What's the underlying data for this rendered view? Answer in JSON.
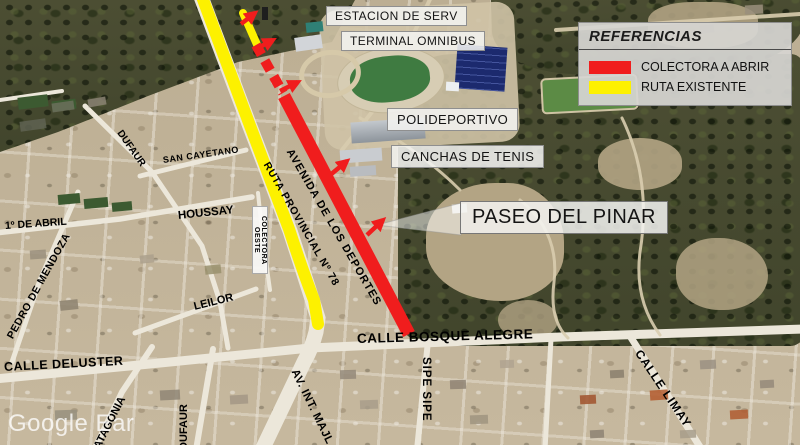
{
  "map": {
    "attribution": "Google Ear",
    "legend": {
      "title": "REFERENCIAS",
      "items": [
        {
          "id": "colectora",
          "label": "COLECTORA A ABRIR",
          "color": "#f01d1d"
        },
        {
          "id": "existente",
          "label": "RUTA EXISTENTE",
          "color": "#fdf100"
        }
      ]
    },
    "callouts": {
      "estacion": "ESTACION DE SERV",
      "terminal": "TERMINAL OMNIBUS",
      "polideportivo": "POLIDEPORTIVO",
      "canchas": "CANCHAS DE TENIS",
      "paseo": "PASEO DEL PINAR"
    },
    "streets": {
      "avenida_deportes": "AVENIDA DE LOS DEPORTES",
      "ruta_provincial": "RUTA PROVINCIAL Nº 78",
      "colectora_oeste": "COLECTORA OESTE",
      "dufaur_norte": "DUFAUR",
      "san_cayetano": "SAN CAYETANO",
      "houssay": "HOUSSAY",
      "primero_de_abril": "1º DE ABRIL",
      "pedro_de_mendoza": "PEDRO DE MENDOZA",
      "leilor": "LEILOR",
      "calle_deluster": "CALLE DELUSTER",
      "patagonia": "PATAGONIA",
      "dufaur_sur": "DUFAUR",
      "bosque_alegre": "CALLE BOSQUE ALEGRE",
      "sipe_sipe": "SIPE SIPE",
      "av_int_majl": "AV. INT. MAJL",
      "calle_limay": "CALLE LIMAY"
    }
  }
}
